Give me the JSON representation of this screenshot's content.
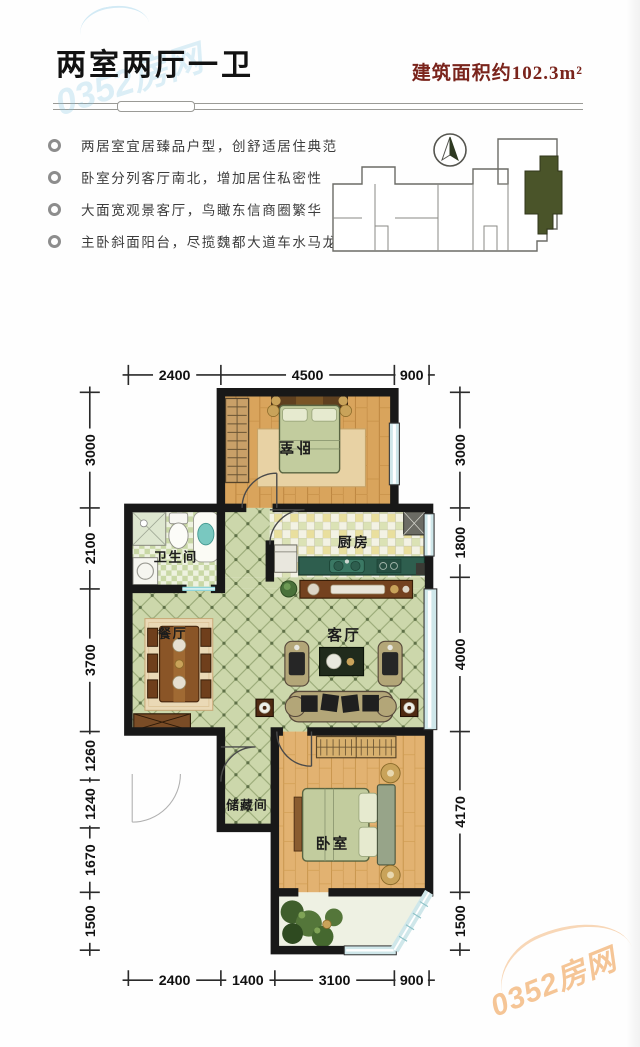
{
  "header": {
    "title": "两室两厅一卫",
    "area_label": "建筑面积约102.3m²"
  },
  "features": [
    "两居室宜居臻品户型，创舒适居住典范",
    "卧室分列客厅南北，增加居住私密性",
    "大面宽观景客厅，鸟瞰东信商圈繁华",
    "主卧斜面阳台，尽揽魏都大道车水马龙"
  ],
  "key_plan": {
    "compass": "north-arrow",
    "unit_highlight_color": "#4a5429"
  },
  "floor_plan": {
    "rooms": {
      "bedroom_north": "卧室",
      "bathroom": "卫生间",
      "kitchen": "厨房",
      "dining": "餐厅",
      "living": "客厅",
      "storage": "储藏间",
      "bedroom_south": "卧室"
    },
    "dimensions": {
      "top": [
        "2400",
        "4500",
        "900"
      ],
      "bottom": [
        "2400",
        "1400",
        "3100",
        "900"
      ],
      "left": [
        "3000",
        "2100",
        "3700",
        "1260",
        "1240",
        "1670",
        "1500"
      ],
      "right": [
        "3000",
        "1800",
        "4000",
        "4170",
        "1500"
      ]
    }
  },
  "watermark": {
    "site": "0352房网"
  },
  "colors": {
    "title_accent": "#7a241c",
    "unit_highlight": "#4a5429",
    "tile_floor": "#ccd7ab",
    "wood_floor": "#d9a45c"
  }
}
